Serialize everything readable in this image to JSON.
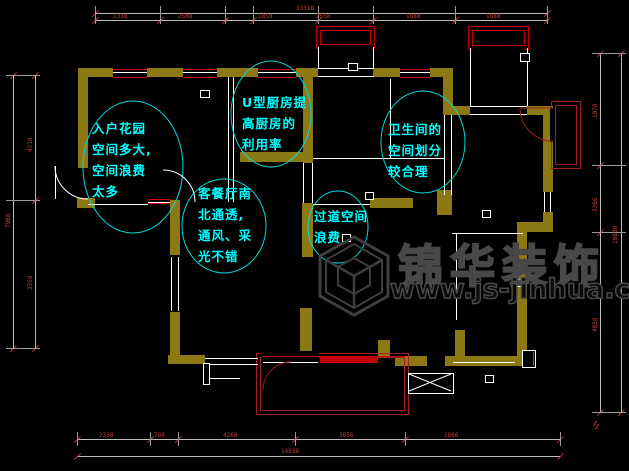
{
  "drawing": {
    "title": "apartment-floor-plan",
    "notes": [
      {
        "id": "entry-garden",
        "lines": [
          "入户花园",
          "空间多大,",
          "空间浪费",
          "太多"
        ]
      },
      {
        "id": "kitchen",
        "lines": [
          "U型厨房提",
          "高厨房的",
          "利用率"
        ]
      },
      {
        "id": "living-dining",
        "lines": [
          "客餐厅南",
          "北通透,",
          "通风、采",
          "光不错"
        ]
      },
      {
        "id": "bathroom",
        "lines": [
          "卫生间的",
          "空间划分",
          "较合理"
        ]
      },
      {
        "id": "corridor",
        "lines": [
          "过道空间",
          "浪费"
        ]
      }
    ],
    "dimensions": {
      "top": {
        "overall": "33318",
        "segments": [
          "1338",
          "2588",
          "1858",
          "2558",
          "1888",
          "1888"
        ]
      },
      "bottom": {
        "overall": "14838",
        "segments": [
          "2338",
          "788",
          "4268",
          "3856",
          "1866"
        ]
      },
      "left": {
        "overall": "7968",
        "segments": [
          "4318",
          "3358"
        ]
      },
      "right": {
        "overall": "10888",
        "segments": [
          "1878",
          "3366",
          "4858"
        ]
      }
    },
    "colors": {
      "wall_olive": "#8d7913",
      "window_red": "#d40000",
      "balcony_red": "#a02020",
      "dimension_red": "#c23c3c",
      "note_cyan": "#00ffff",
      "line_white": "#ffffff",
      "watermark_gray": "#484848"
    }
  },
  "watermark": {
    "brand": "锦华装饰",
    "url": "www.js-jinhua.com"
  }
}
